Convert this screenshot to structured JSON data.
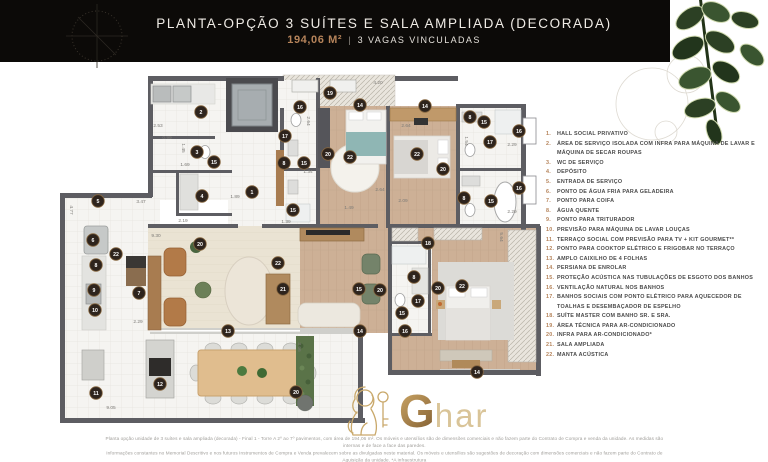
{
  "header": {
    "title": "PLANTA-OPÇÃO 3 SUÍTES E SALA AMPLIADA (DECORADA)",
    "area": "194,06 M²",
    "separator": "|",
    "parking": "3 VAGAS VINCULADAS"
  },
  "colors": {
    "accent_copper": "#b5835a",
    "header_bg": "#0c0a08",
    "wall": "#5d5d62",
    "marker_bg": "#2e241d",
    "wood": "#cdb096",
    "plant_green": "#3a5530"
  },
  "legend": {
    "items": [
      {
        "num": "1.",
        "text": "HALL SOCIAL PRIVATIVO"
      },
      {
        "num": "2.",
        "text": "ÁREA DE SERVIÇO ISOLADA COM INFRA PARA MÁQUINA DE LAVAR E MÁQUINA DE SECAR ROUPAS"
      },
      {
        "num": "3.",
        "text": "WC DE SERVIÇO"
      },
      {
        "num": "4.",
        "text": "DEPÓSITO"
      },
      {
        "num": "5.",
        "text": "ENTRADA DE SERVIÇO"
      },
      {
        "num": "6.",
        "text": "PONTO DE ÁGUA FRIA PARA GELADEIRA"
      },
      {
        "num": "7.",
        "text": "PONTO PARA COIFA"
      },
      {
        "num": "8.",
        "text": "ÁGUA QUENTE"
      },
      {
        "num": "9.",
        "text": "PONTO PARA TRITURADOR"
      },
      {
        "num": "10.",
        "text": "PREVISÃO PARA MÁQUINA DE LAVAR LOUÇAS"
      },
      {
        "num": "11.",
        "text": "TERRAÇO SOCIAL COM PREVISÃO PARA TV + KIT GOURMET**"
      },
      {
        "num": "12.",
        "text": "PONTO PARA COOKTOP ELÉTRICO E FRIGOBAR NO TERRAÇO"
      },
      {
        "num": "13.",
        "text": "AMPLO CAIXILHO DE 4 FOLHAS"
      },
      {
        "num": "14.",
        "text": "PERSIANA DE ENROLAR"
      },
      {
        "num": "15.",
        "text": "PROTEÇÃO ACÚSTICA NAS TUBULAÇÕES DE ESGOTO DOS BANHOS"
      },
      {
        "num": "16.",
        "text": "VENTILAÇÃO NATURAL NOS BANHOS"
      },
      {
        "num": "17.",
        "text": "BANHOS SOCIAIS COM PONTO ELÉTRICO PARA AQUECEDOR DE TOALHAS E DESEMBAÇADOR DE ESPELHO"
      },
      {
        "num": "18.",
        "text": "SUÍTE MASTER COM BANHO SR. E SRA."
      },
      {
        "num": "19.",
        "text": "ÁREA TÉCNICA PARA AR-CONDICIONADO"
      },
      {
        "num": "20.",
        "text": "INFRA PARA AR-CONDICIONADO*"
      },
      {
        "num": "21.",
        "text": "SALA AMPLIADA"
      },
      {
        "num": "22.",
        "text": "MANTA ACÚSTICA"
      }
    ]
  },
  "plan": {
    "markers": [
      {
        "n": "1",
        "x": 252,
        "y": 192
      },
      {
        "n": "2",
        "x": 201,
        "y": 112
      },
      {
        "n": "3",
        "x": 197,
        "y": 152
      },
      {
        "n": "4",
        "x": 202,
        "y": 196
      },
      {
        "n": "5",
        "x": 98,
        "y": 201
      },
      {
        "n": "6",
        "x": 93,
        "y": 240
      },
      {
        "n": "7",
        "x": 139,
        "y": 293
      },
      {
        "n": "8",
        "x": 96,
        "y": 265
      },
      {
        "n": "8",
        "x": 284,
        "y": 163
      },
      {
        "n": "8",
        "x": 470,
        "y": 117
      },
      {
        "n": "8",
        "x": 464,
        "y": 198
      },
      {
        "n": "8",
        "x": 414,
        "y": 277
      },
      {
        "n": "9",
        "x": 94,
        "y": 290
      },
      {
        "n": "10",
        "x": 95,
        "y": 310
      },
      {
        "n": "11",
        "x": 96,
        "y": 393
      },
      {
        "n": "12",
        "x": 160,
        "y": 384
      },
      {
        "n": "13",
        "x": 228,
        "y": 331
      },
      {
        "n": "14",
        "x": 360,
        "y": 105
      },
      {
        "n": "14",
        "x": 425,
        "y": 106
      },
      {
        "n": "14",
        "x": 360,
        "y": 331
      },
      {
        "n": "14",
        "x": 477,
        "y": 372
      },
      {
        "n": "15",
        "x": 214,
        "y": 162
      },
      {
        "n": "15",
        "x": 304,
        "y": 163
      },
      {
        "n": "15",
        "x": 293,
        "y": 210
      },
      {
        "n": "15",
        "x": 484,
        "y": 122
      },
      {
        "n": "15",
        "x": 491,
        "y": 201
      },
      {
        "n": "15",
        "x": 402,
        "y": 313
      },
      {
        "n": "15",
        "x": 359,
        "y": 289
      },
      {
        "n": "16",
        "x": 300,
        "y": 107
      },
      {
        "n": "16",
        "x": 519,
        "y": 131
      },
      {
        "n": "16",
        "x": 519,
        "y": 188
      },
      {
        "n": "16",
        "x": 405,
        "y": 331
      },
      {
        "n": "17",
        "x": 285,
        "y": 136
      },
      {
        "n": "17",
        "x": 490,
        "y": 142
      },
      {
        "n": "17",
        "x": 418,
        "y": 301
      },
      {
        "n": "18",
        "x": 428,
        "y": 243
      },
      {
        "n": "19",
        "x": 330,
        "y": 93
      },
      {
        "n": "20",
        "x": 328,
        "y": 154
      },
      {
        "n": "20",
        "x": 443,
        "y": 169
      },
      {
        "n": "20",
        "x": 200,
        "y": 244
      },
      {
        "n": "20",
        "x": 380,
        "y": 290
      },
      {
        "n": "20",
        "x": 438,
        "y": 288
      },
      {
        "n": "20",
        "x": 296,
        "y": 392
      },
      {
        "n": "21",
        "x": 283,
        "y": 289
      },
      {
        "n": "22",
        "x": 116,
        "y": 254
      },
      {
        "n": "22",
        "x": 350,
        "y": 157
      },
      {
        "n": "22",
        "x": 417,
        "y": 154
      },
      {
        "n": "22",
        "x": 462,
        "y": 286
      },
      {
        "n": "22",
        "x": 278,
        "y": 263
      }
    ],
    "dimensions": [
      {
        "t": "2.53",
        "x": 158,
        "y": 127,
        "r": 0
      },
      {
        "t": "0.99",
        "x": 167,
        "y": 139,
        "r": 0
      },
      {
        "t": "1.45",
        "x": 182,
        "y": 148,
        "r": 90
      },
      {
        "t": "1.69",
        "x": 185,
        "y": 166,
        "r": 0
      },
      {
        "t": "3.47",
        "x": 141,
        "y": 203,
        "r": 0
      },
      {
        "t": "4.77",
        "x": 70,
        "y": 210,
        "r": 90
      },
      {
        "t": "2.19",
        "x": 183,
        "y": 222,
        "r": 0
      },
      {
        "t": "9.30",
        "x": 156,
        "y": 237,
        "r": 0
      },
      {
        "t": "1.89",
        "x": 235,
        "y": 198,
        "r": 0
      },
      {
        "t": "1.34",
        "x": 308,
        "y": 173,
        "r": 0
      },
      {
        "t": "1.39",
        "x": 286,
        "y": 223,
        "r": 0
      },
      {
        "t": "2.64",
        "x": 380,
        "y": 191,
        "r": 0
      },
      {
        "t": "1.49",
        "x": 349,
        "y": 209,
        "r": 0
      },
      {
        "t": "2.09",
        "x": 403,
        "y": 202,
        "r": 0
      },
      {
        "t": "4.20",
        "x": 378,
        "y": 84,
        "r": 0
      },
      {
        "t": "2.64",
        "x": 307,
        "y": 121,
        "r": 90
      },
      {
        "t": "2.64",
        "x": 406,
        "y": 127,
        "r": 0
      },
      {
        "t": "1.54",
        "x": 465,
        "y": 141,
        "r": 90
      },
      {
        "t": "2.29",
        "x": 512,
        "y": 146,
        "r": 0
      },
      {
        "t": "2.29",
        "x": 512,
        "y": 213,
        "r": 0
      },
      {
        "t": "2.29",
        "x": 138,
        "y": 323,
        "r": 0
      },
      {
        "t": "9.05",
        "x": 111,
        "y": 409,
        "r": 0
      },
      {
        "t": "3.66",
        "x": 298,
        "y": 347,
        "r": 90
      },
      {
        "t": "5.64",
        "x": 500,
        "y": 237,
        "r": 90
      }
    ]
  },
  "logo": {
    "brand_g": "G",
    "brand_rest": "har"
  },
  "footer": {
    "lines": [
      "Planta opção unidade de 3 suítes e sala ampliada (decorada) - Final 1 - Torre A 2º ao 7º pavimentos, com área de 194,06 m². Os móveis e utensílios são de dimensões comerciais e não fazem parte do Contrato de Compra e venda da unidade. As medidas são internas e de face a face das paredes.",
      "Informações constantes no Memorial Descritivo e nos futuros Instrumentos de Compra e Venda prevalecem sobre as divulgadas neste material. Os móveis e utensílios são sugestões de decoração com dimensões comerciais e não fazem parte do Contrato de Aquisição da unidade. *A infraestrutura",
      "necessária para instalação do ar-condicionado poderá ser adquirida dentro do prazo estabelecido pela Construtora, pelo proprietário, com custo, junto ao MAC Decora. **Kit Gourmet compreende bancada, cuba e churrasqueira a carvão e poderá ser adquirido junto ao MAC Decora."
    ]
  }
}
